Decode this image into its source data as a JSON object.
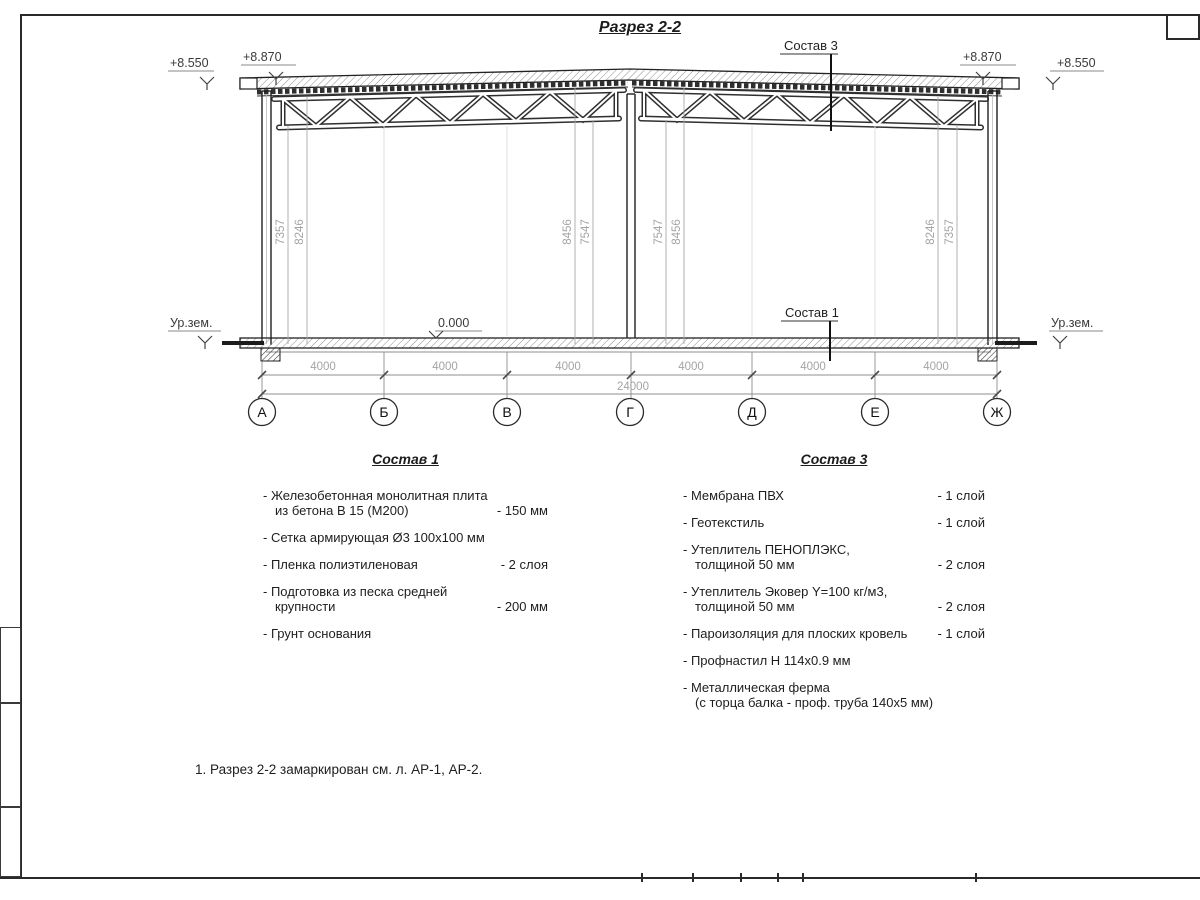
{
  "drawing": {
    "title": "Разрез 2-2",
    "elev_outer_left": "+8.550",
    "elev_inner_left": "+8.870",
    "elev_inner_right": "+8.870",
    "elev_outer_right": "+8.550",
    "ground_left": "Ур.зем.",
    "ground_right": "Ур.зем.",
    "floor_level": "0.000",
    "leader_sostav3": "Состав 3",
    "leader_sostav1": "Состав 1",
    "vdims": [
      "7357",
      "8246",
      "8456",
      "7547",
      "7547",
      "8456",
      "8246",
      "7357"
    ],
    "bays": [
      "4000",
      "4000",
      "4000",
      "4000",
      "4000",
      "4000"
    ],
    "total": "24000",
    "axes": [
      "А",
      "Б",
      "В",
      "Г",
      "Д",
      "Е",
      "Ж"
    ]
  },
  "sostav1": {
    "title": "Состав 1",
    "items": [
      {
        "text": "- Железобетонная  монолитная плита\nиз бетона В 15 (М200)",
        "value": "- 150 мм"
      },
      {
        "text": "- Сетка армирующая Ø3 100x100 мм",
        "value": ""
      },
      {
        "text": "- Пленка полиэтиленовая",
        "value": "- 2 слоя"
      },
      {
        "text": "- Подготовка из песка средней\nкрупности",
        "value": "- 200 мм"
      },
      {
        "text": "- Грунт основания",
        "value": ""
      }
    ]
  },
  "sostav3": {
    "title": "Состав 3",
    "items": [
      {
        "text": "- Мембрана ПВХ",
        "value": "- 1 слой"
      },
      {
        "text": "- Геотекстиль",
        "value": "- 1 слой"
      },
      {
        "text": "- Утеплитель ПЕНОПЛЭКС,\nтолщиной 50 мм",
        "value": "- 2 слоя"
      },
      {
        "text": "- Утеплитель Эковер Y=100 кг/м3,\nтолщиной 50 мм",
        "value": "- 2 слоя"
      },
      {
        "text": "- Пароизоляция для плоских кровель",
        "value": "- 1 слой"
      },
      {
        "text": "- Профнастил Н 114х0.9 мм",
        "value": ""
      },
      {
        "text": "- Металлическая ферма\n(с торца балка - проф. труба 140х5 мм)",
        "value": ""
      }
    ]
  },
  "note": "1. Разрез 2-2 замаркирован см. л. АР-1, АР-2."
}
